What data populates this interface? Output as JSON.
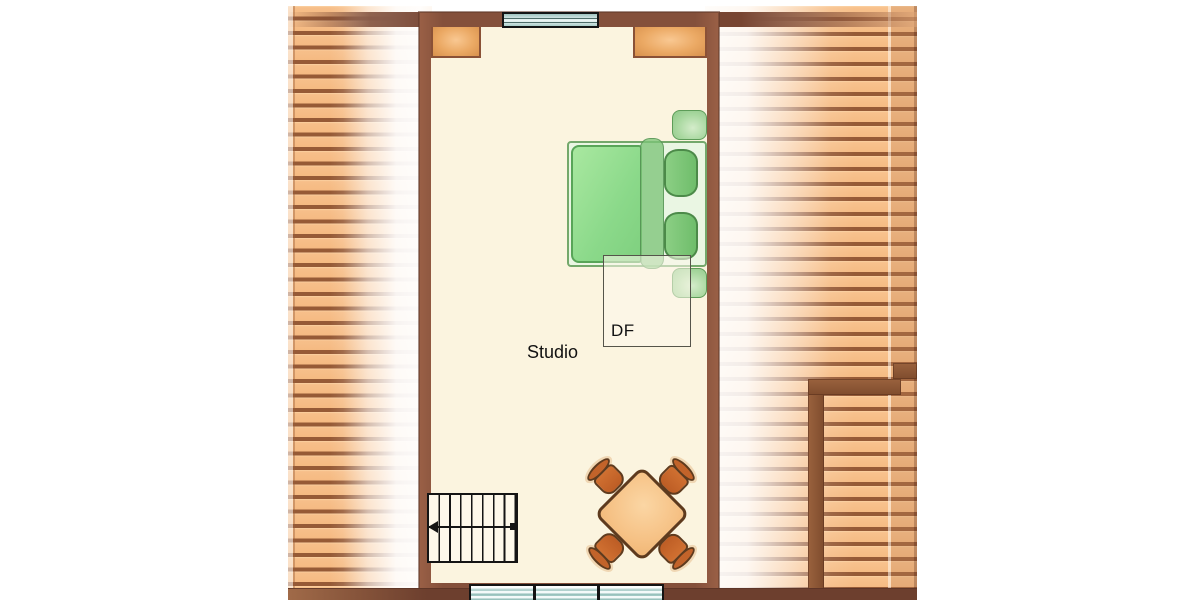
{
  "labels": {
    "room": "Studio",
    "dormer": "DF"
  },
  "colors": {
    "wall_brown": "#774532",
    "floor_cream": "#fbf4df",
    "deck_plank_orange": "#f7bf8a",
    "deck_gap_brown": "#965a36",
    "window_glass_teal": "#a7cdc8",
    "bed_green": "#8bd98a",
    "pillow_green": "#6fbd6b",
    "table_orange": "#f6c286",
    "chair_orange": "#c2632a",
    "nook_tan": "#eba964"
  }
}
